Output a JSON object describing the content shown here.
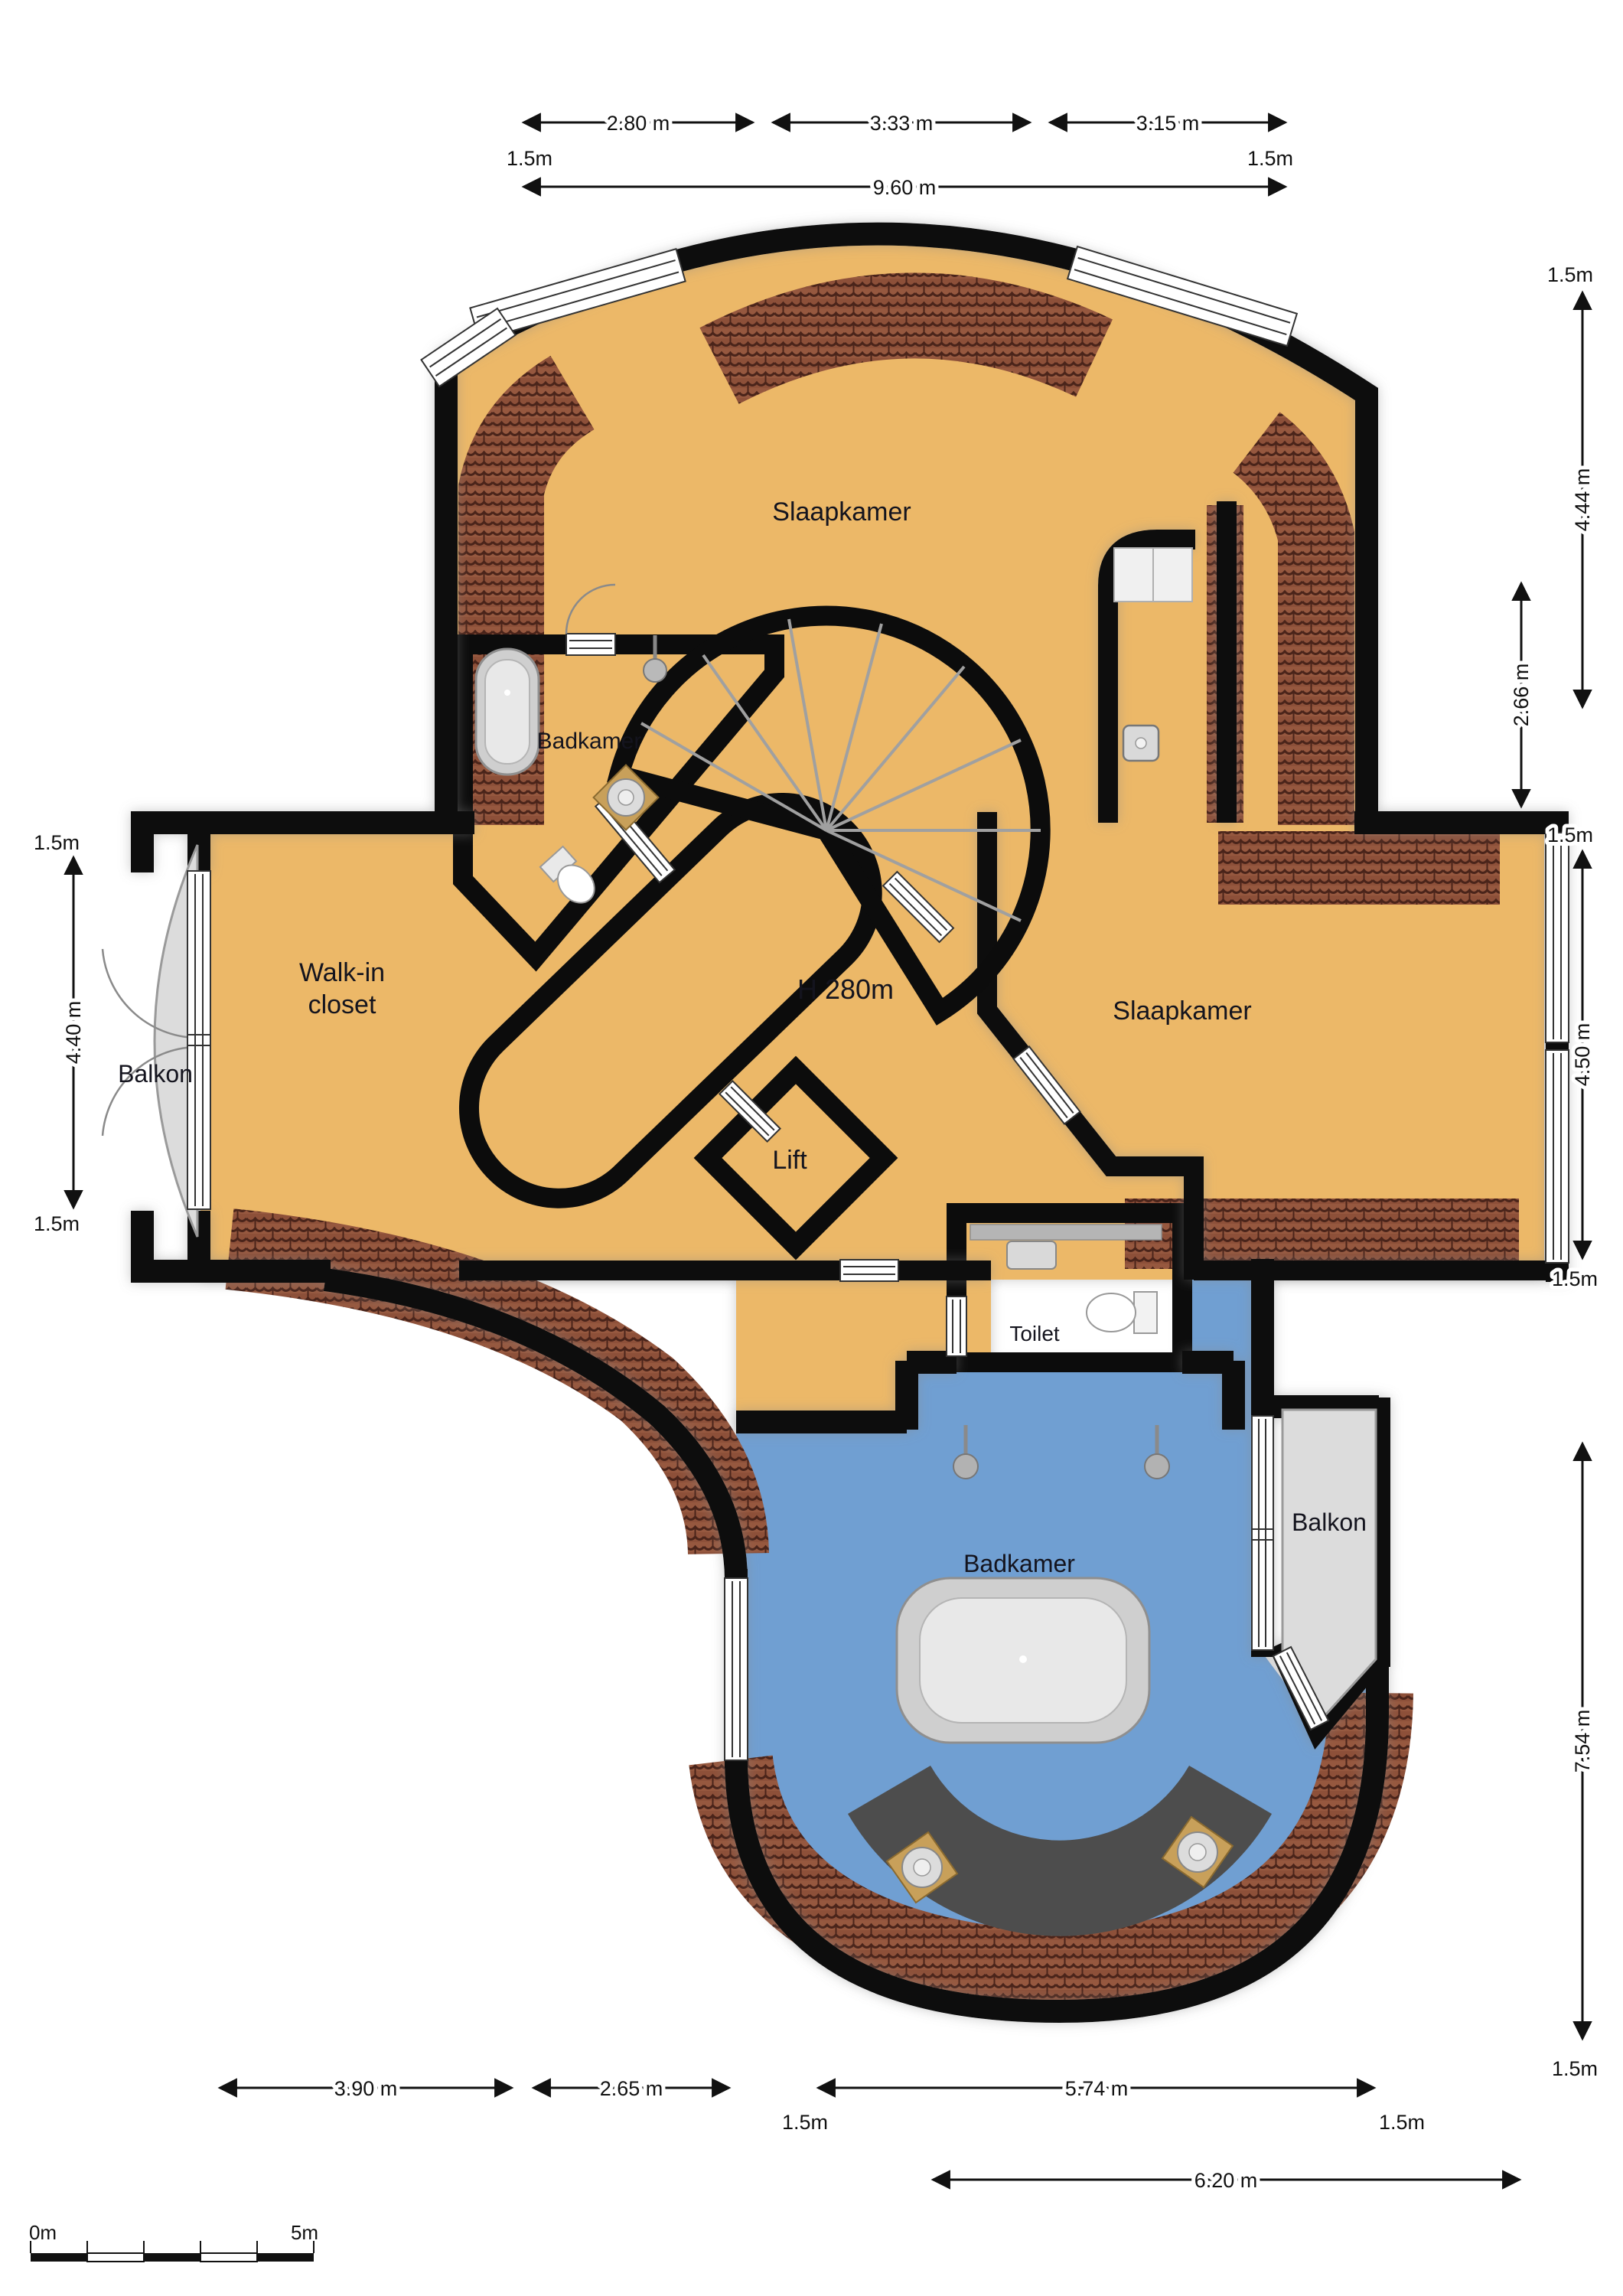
{
  "rooms": {
    "slaapkamer_top": "Slaapkamer",
    "badkamer_top": "Badkamer",
    "walk_in_line1": "Walk-in",
    "walk_in_line2": "closet",
    "height_note": "H 280m",
    "slaapkamer_right": "Slaapkamer",
    "balkon_left": "Balkon",
    "lift": "Lift",
    "toilet": "Toilet",
    "badkamer_bottom": "Badkamer",
    "balkon_right": "Balkon"
  },
  "dimensions": {
    "top": {
      "segments": [
        "2.80 m",
        "3.33 m",
        "3.15 m"
      ],
      "margins": [
        "1.5m",
        "1.5m"
      ],
      "total": "9.60 m"
    },
    "right": {
      "labels": [
        "1.5m",
        "4.44 m",
        "2.66 m",
        "1.5m",
        "4.50 m",
        "1.5m",
        "7.54 m",
        "1.5m"
      ]
    },
    "left": {
      "labels": [
        "1.5m",
        "4.40 m",
        "1.5m"
      ]
    },
    "bottom": {
      "labels": [
        "3.90 m",
        "2.65 m",
        "1.5m",
        "5.74 m",
        "1.5m",
        "6.20 m"
      ]
    }
  },
  "scale_bar": {
    "start": "0m",
    "end": "5m"
  },
  "colors": {
    "floor_bedroom": "#ecb868",
    "floor_bath": "#6f9fd2",
    "wall": "#0c0c0c",
    "roof_tile": "#96583f",
    "roof_tile_dark": "#4a241a",
    "balcony": "#dcdcdc",
    "stairs": "#d7d7d7",
    "lift": "#d6d6d6",
    "dark_band": "#4d4d4d",
    "fixture_light": "#cfcfcf",
    "fixture_lighter": "#e8e8e8"
  }
}
